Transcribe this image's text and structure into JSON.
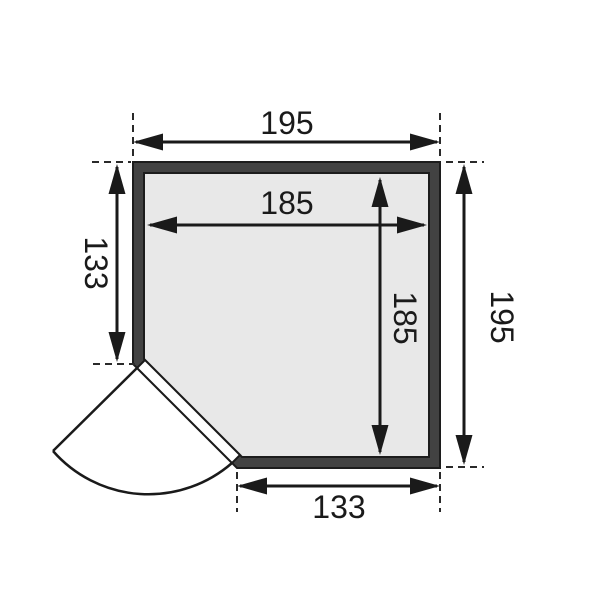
{
  "diagram": {
    "dimensions": {
      "top_width": "195",
      "inner_width": "185",
      "inner_height": "185",
      "left_height": "133",
      "right_height": "195",
      "bottom_width": "133"
    },
    "colors": {
      "wall_fill": "#424242",
      "interior_fill": "#e8e8e8",
      "line": "#1a1a1a",
      "background": "#ffffff"
    }
  }
}
